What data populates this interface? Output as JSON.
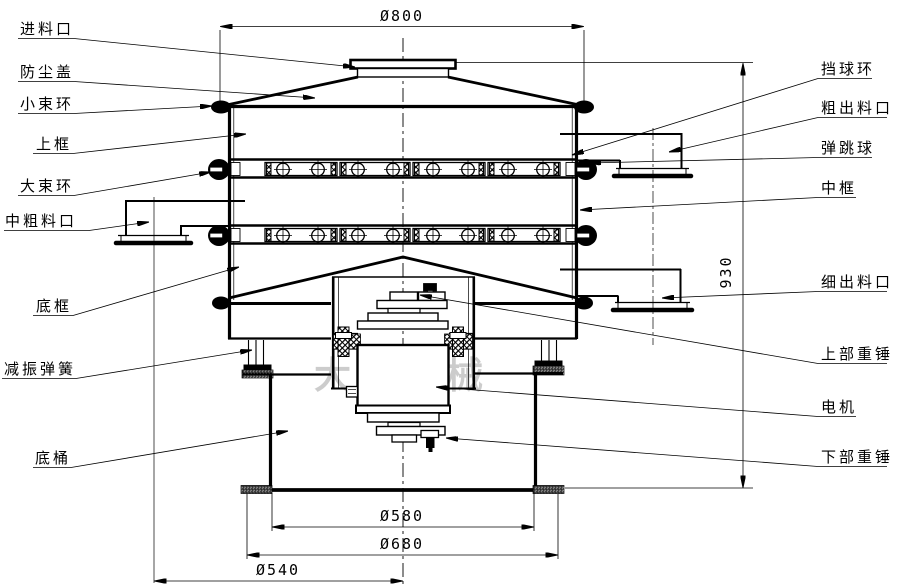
{
  "watermark": {
    "text": "大汉机械"
  },
  "labels": {
    "left": [
      {
        "text": "进料口"
      },
      {
        "text": "防尘盖"
      },
      {
        "text": "小束环"
      },
      {
        "text": "上框"
      },
      {
        "text": "大束环"
      },
      {
        "text": "中粗料口"
      },
      {
        "text": "底框"
      },
      {
        "text": "减振弹簧"
      },
      {
        "text": "底桶"
      }
    ],
    "right": [
      {
        "text": "挡球环"
      },
      {
        "text": "粗出料口"
      },
      {
        "text": "弹跳球"
      },
      {
        "text": "中框"
      },
      {
        "text": "细出料口"
      },
      {
        "text": "上部重锤"
      },
      {
        "text": "电机"
      },
      {
        "text": "下部重锤"
      }
    ]
  },
  "dimensions": {
    "top_diameter": "Ø800",
    "total_height": "930",
    "barrel_diameter": "Ø580",
    "base_diameter": "Ø680",
    "outlet_span": "Ø540"
  }
}
